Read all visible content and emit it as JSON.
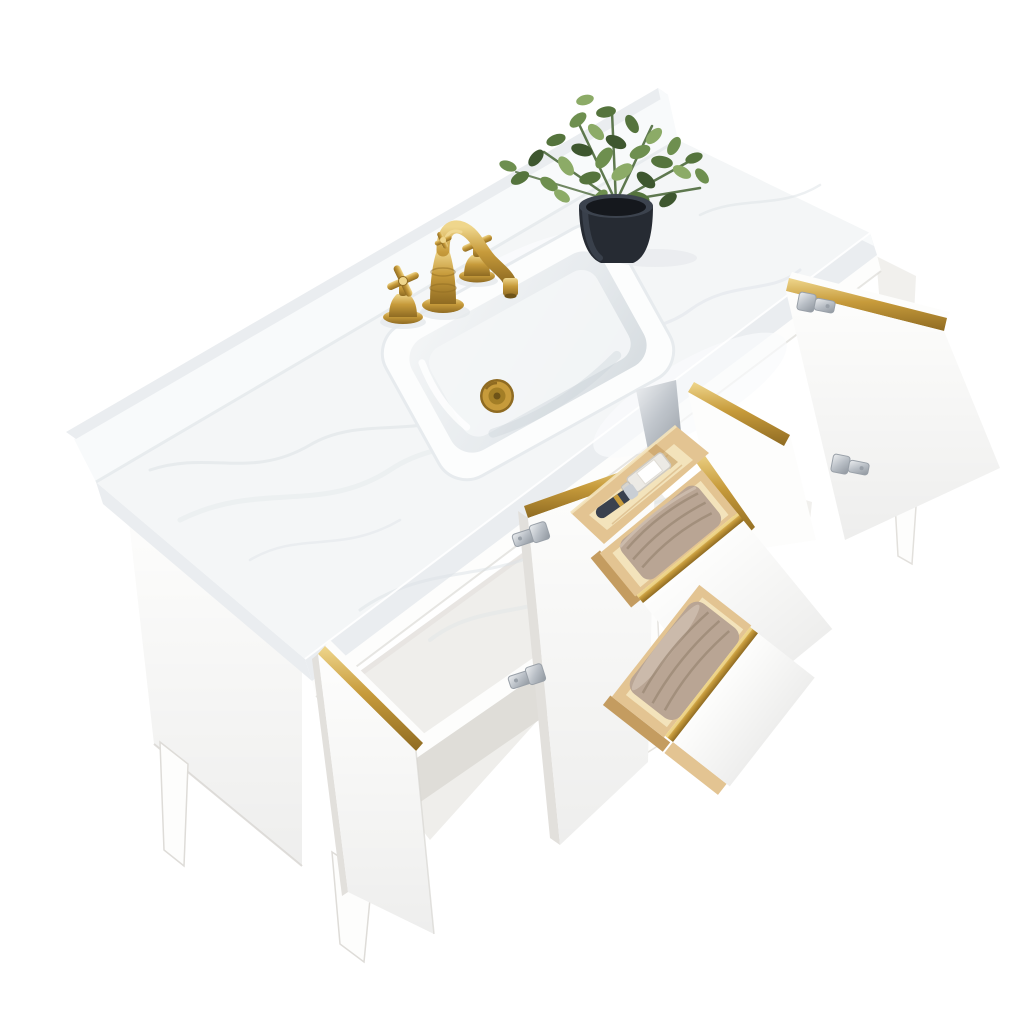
{
  "meta": {
    "title": "Bathroom vanity product photo",
    "kind": "studio product photograph",
    "background": "seamless white"
  },
  "description": "Top-down angled studio photo of a white freestanding single-sink bathroom vanity with white marble countertop and backsplash, brushed gold widespread faucet with cross handles, white rectangular undermount sink with gold pop-up drain, a faux green plant in a black pot, three open gold-trimmed doors with chrome hinges, and three open drawers: a top drawer with a pine organizer tray holding a perfume bottle and a black razor, and two lower drawers with folded taupe towels.",
  "scene": {
    "countertop": {
      "label": "white engineered marble countertop",
      "backsplash": "matching marble backsplash along back edge",
      "veining": "soft gray"
    },
    "sink": {
      "label": "rectangular undermount ceramic sink",
      "color": "white",
      "drain": "brushed gold pop-up drain"
    },
    "faucet": {
      "label": "widespread lavatory faucet",
      "finish": "brushed gold",
      "handle_style": "cross",
      "handle_count": 2,
      "spout": "curved traditional spout with cross finial"
    },
    "plant": {
      "label": "faux eucalyptus plant",
      "pot": "black tapered round pot"
    },
    "cabinet": {
      "label": "white freestanding vanity cabinet",
      "legs": "tapered white wood legs",
      "trim": "brushed gold edge trim on doors and drawer fronts",
      "hinges": "polished chrome concealed hinges",
      "doors": [
        {
          "position": "lower-left",
          "state": "open",
          "visible_face": "outer",
          "trim": "gold edge strip"
        },
        {
          "position": "center",
          "state": "open",
          "visible_face": "inner",
          "hinges": 2
        },
        {
          "position": "right",
          "state": "open wide",
          "visible_face": "inner",
          "hinges": 2
        }
      ],
      "drawers": [
        {
          "position": "top",
          "state": "open",
          "contents": [
            "pine organizer tray",
            "clear perfume bottle with white label",
            "black razor"
          ]
        },
        {
          "position": "middle",
          "state": "open",
          "contents": [
            "folded taupe towel"
          ]
        },
        {
          "position": "bottom",
          "state": "open",
          "contents": [
            "folded taupe towel"
          ]
        }
      ],
      "interior": "open shelf compartment behind center doors"
    }
  },
  "colors": {
    "bg": "#FFFFFF",
    "marble": "#F4F6F7",
    "marbleEdge": "#EAEDF0",
    "marbleVein": "#DCE1E6",
    "backsplashFace": "#F8FAFB",
    "white": "#FDFDFC",
    "whiteShade": "#F1F0ED",
    "whiteDeep": "#E2E0DC",
    "line": "#D7D5D1",
    "interior": "#EFEEEB",
    "shelfShadow": "#DFDDD8",
    "gold": "#C79B3B",
    "goldHi": "#EFD68C",
    "goldLo": "#8F6B22",
    "wood": "#E3C492",
    "woodHi": "#F3E3BB",
    "woodLo": "#C49C60",
    "towel": "#B9A594",
    "towelHi": "#CDBCAD",
    "towelLo": "#998672",
    "chrome": "#CDD2D7",
    "chromeLo": "#99A0A8",
    "pot": "#262B33",
    "potHi": "#3C434E",
    "soil": "#15181D",
    "leafDark": "#3E572F",
    "leaf": "#55743D",
    "leafMid": "#6E8F4F",
    "leafLight": "#8CAB67",
    "stem": "#4E6A3C",
    "bowl": "#E9EDEF",
    "bowlDeep": "#D6DCE0"
  }
}
